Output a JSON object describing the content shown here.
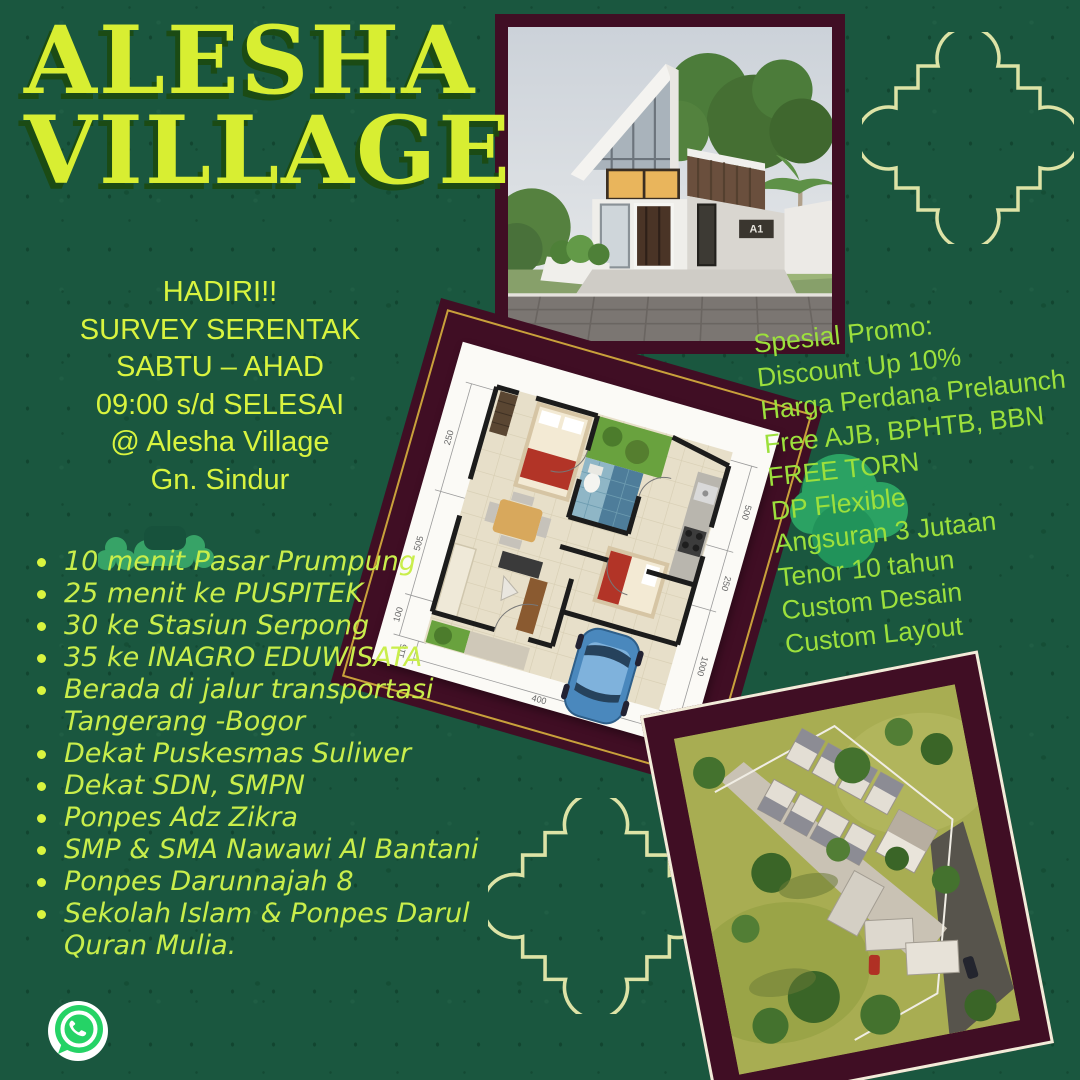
{
  "poster": {
    "title": {
      "line1": "ALESHA",
      "line2": "VILLAGE"
    },
    "event": {
      "lines": [
        "HADIRI!!",
        "SURVEY SERENTAK",
        "SABTU – AHAD",
        "09:00 s/d SELESAI",
        "@ Alesha Village",
        "Gn. Sindur"
      ]
    },
    "locations": [
      "10 menit Pasar Prumpung",
      "25 menit ke PUSPITEK",
      "30 ke Stasiun Serpong",
      "35 ke INAGRO EDUWISATA",
      "Berada di jalur transportasi Tangerang -Bogor",
      "Dekat Puskesmas Suliwer",
      "Dekat SDN, SMPN",
      "Ponpes Adz Zikra",
      "SMP & SMA Nawawi Al Bantani",
      "Ponpes Darunnajah 8",
      "Sekolah Islam & Ponpes Darul Quran Mulia."
    ],
    "promo": {
      "lines": [
        "Spesial Promo:",
        "Discount Up 10%",
        "Harga Perdana Prelaunch",
        "Free AJB, BPHTB, BBN",
        "FREE TORN",
        "DP Flexible",
        "Angsuran 3 Jutaan",
        "Tenor 10 tahun",
        "Custom Desain",
        "Custom Layout"
      ]
    },
    "house_photo": {
      "label": "A1"
    },
    "floorplan": {
      "dims": [
        "250",
        "505",
        "100",
        "115",
        "500",
        "250",
        "1000",
        "400"
      ]
    },
    "icons": {
      "whatsapp": "whatsapp-icon"
    },
    "colors": {
      "background": "#1A573F",
      "title": "#D8EE32",
      "event_text": "#D9F43F",
      "list_text": "#C9EE4B",
      "promo_text": "#9CE03C",
      "frame_maroon": "#400E24",
      "frame_gold": "#C9A13B",
      "frame_cream": "#F2ECD9",
      "ornament_outline": "#DDE3A6",
      "blob_green": "#2FA365",
      "whatsapp_green": "#25D366"
    }
  }
}
